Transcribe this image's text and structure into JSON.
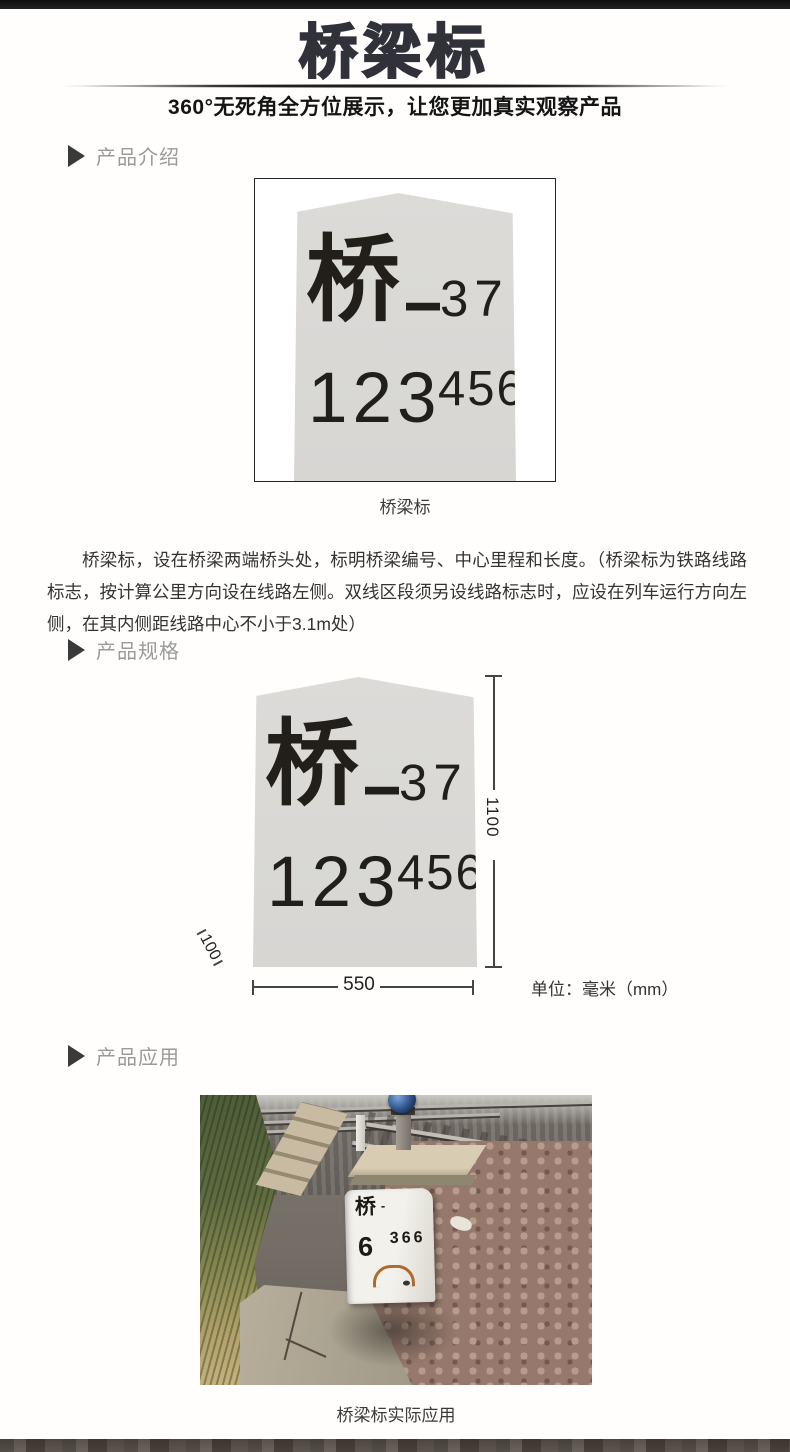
{
  "header": {
    "title": "桥梁标",
    "subtitle": "360°无死角全方位展示，让您更加真实观察产品"
  },
  "marker_face": {
    "char": "桥",
    "dash": "—",
    "serial": "37",
    "km": "123",
    "m": "456"
  },
  "sections": {
    "intro": {
      "heading": "产品介绍",
      "image_caption": "桥梁标",
      "description": "桥梁标，设在桥梁两端桥头处，标明桥梁编号、中心里程和长度。（桥梁标为铁路线路标志，按计算公里方向设在线路左侧。双线区段须另设线路标志时，应设在列车运行方向左侧，在其内侧距线路中心不小于3.1m处）"
    },
    "specs": {
      "heading": "产品规格",
      "height_mm": "1100",
      "width_mm": "550",
      "bevel_mm": "100",
      "unit_label": "单位：毫米（mm）"
    },
    "application": {
      "heading": "产品应用",
      "caption": "桥梁标实际应用",
      "photo_marker": {
        "char": "桥",
        "dash": "-",
        "num_left": "6",
        "num_right": "366"
      }
    }
  },
  "colors": {
    "title_text": "#31313a",
    "section_heading_text": "#9a9a9a",
    "stone_fill": "#d9d8d5",
    "stone_text": "#221e1a",
    "rust_mark": "#a8601f"
  }
}
